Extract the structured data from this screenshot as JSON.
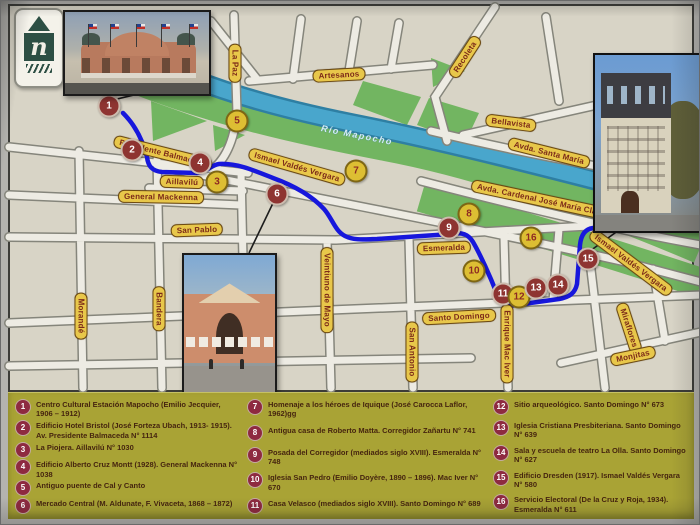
{
  "logo": {
    "letter": "n"
  },
  "map": {
    "colors": {
      "route": "#1717dc",
      "river": "#49a6cc",
      "park": "#72b561",
      "label_bg": "#e8c74a",
      "marker_red": "#8e3431",
      "marker_yellow": "#ddbe33",
      "legend_bg": "#a9a335"
    },
    "river_label": {
      "text": "Río Mapocho",
      "x": 356,
      "y": 134,
      "r": 11
    },
    "street_labels": [
      {
        "text": "Presidente Balmaceda",
        "x": 162,
        "y": 152,
        "r": 14
      },
      {
        "text": "General Mackenna",
        "x": 160,
        "y": 196,
        "r": 1
      },
      {
        "text": "Aillavilú",
        "x": 181,
        "y": 181,
        "r": 2
      },
      {
        "text": "San Pablo",
        "x": 196,
        "y": 229,
        "r": -2
      },
      {
        "text": "Morandé",
        "x": 80,
        "y": 315,
        "r": 90
      },
      {
        "text": "Bandera",
        "x": 158,
        "y": 308,
        "r": 90
      },
      {
        "text": "Veintiuno de Mayo",
        "x": 326,
        "y": 289,
        "r": 90
      },
      {
        "text": "San Antonio",
        "x": 411,
        "y": 351,
        "r": 90
      },
      {
        "text": "Santo Domingo",
        "x": 458,
        "y": 316,
        "r": -3
      },
      {
        "text": "Enrique Mac Iver",
        "x": 506,
        "y": 343,
        "r": 90
      },
      {
        "text": "Esmeralda",
        "x": 443,
        "y": 247,
        "r": -2
      },
      {
        "text": "Miraflores",
        "x": 628,
        "y": 327,
        "r": 72
      },
      {
        "text": "Monjitas",
        "x": 632,
        "y": 355,
        "r": -12
      },
      {
        "text": "La Paz",
        "x": 234,
        "y": 62,
        "r": 90
      },
      {
        "text": "Artesanos",
        "x": 338,
        "y": 74,
        "r": -3
      },
      {
        "text": "Recoleta",
        "x": 464,
        "y": 56,
        "r": -57
      },
      {
        "text": "Bellavista",
        "x": 510,
        "y": 122,
        "r": 7
      },
      {
        "text": "Avda. Santa María",
        "x": 548,
        "y": 152,
        "r": 14
      },
      {
        "text": "Avda. Cardenal José María Claro",
        "x": 540,
        "y": 199,
        "r": 12
      },
      {
        "text": "Ismael Valdés Vergara",
        "x": 296,
        "y": 166,
        "r": 16
      },
      {
        "text": "Ismael Valdés Vergara",
        "x": 630,
        "y": 262,
        "r": 37
      }
    ],
    "markers": [
      {
        "n": "1",
        "x": 108,
        "y": 105,
        "c": "red"
      },
      {
        "n": "2",
        "x": 131,
        "y": 149,
        "c": "red"
      },
      {
        "n": "3",
        "x": 216,
        "y": 181,
        "c": "yellow"
      },
      {
        "n": "4",
        "x": 199,
        "y": 162,
        "c": "red"
      },
      {
        "n": "5",
        "x": 236,
        "y": 120,
        "c": "yellow"
      },
      {
        "n": "6",
        "x": 276,
        "y": 193,
        "c": "red"
      },
      {
        "n": "7",
        "x": 355,
        "y": 170,
        "c": "yellow"
      },
      {
        "n": "8",
        "x": 468,
        "y": 213,
        "c": "yellow"
      },
      {
        "n": "9",
        "x": 448,
        "y": 227,
        "c": "red"
      },
      {
        "n": "10",
        "x": 473,
        "y": 270,
        "c": "yellow"
      },
      {
        "n": "11",
        "x": 502,
        "y": 293,
        "c": "red"
      },
      {
        "n": "12",
        "x": 518,
        "y": 296,
        "c": "yellow"
      },
      {
        "n": "13",
        "x": 535,
        "y": 287,
        "c": "red"
      },
      {
        "n": "14",
        "x": 557,
        "y": 284,
        "c": "red"
      },
      {
        "n": "15",
        "x": 587,
        "y": 258,
        "c": "red"
      },
      {
        "n": "16",
        "x": 530,
        "y": 237,
        "c": "yellow"
      }
    ]
  },
  "legend": {
    "columns": [
      {
        "items": [
          {
            "n": "1",
            "text": "Centro Cultural Estación Mapocho (Emilio Jecquier, 1906 – 1912)"
          },
          {
            "n": "2",
            "text": "Edificio Hotel Bristol (José Forteza Ubach, 1913- 1915). Av. Presidente Balmaceda N° 1114"
          },
          {
            "n": "3",
            "text": "La Piojera. Aillavilú N° 1030"
          },
          {
            "n": "4",
            "text": "Edificio Alberto Cruz Montt (1928). General Mackenna N° 1038"
          },
          {
            "n": "5",
            "text": "Antiguo puente de Cal y Canto"
          },
          {
            "n": "6",
            "text": "Mercado Central (M. Aldunate, F. Vivaceta, 1868 – 1872)"
          }
        ]
      },
      {
        "items": [
          {
            "n": "7",
            "text": "Homenaje a los héroes de Iquique (José Carocca Laflor, 1962)gg"
          },
          {
            "n": "8",
            "text": "Antigua casa de Roberto Matta. Corregidor Zañartu N° 741"
          },
          {
            "n": "9",
            "text": "Posada del Corregidor (mediados siglo XVIII). Esmeralda N° 748"
          },
          {
            "n": "10",
            "text": "Iglesia San Pedro (Emilio Doyère, 1890 – 1896). Mac Iver N° 670"
          },
          {
            "n": "11",
            "text": "Casa Velasco (mediados siglo XVIII). Santo Domingo N° 689"
          }
        ]
      },
      {
        "items": [
          {
            "n": "12",
            "text": "Sitio arqueológico. Santo Domingo N° 673"
          },
          {
            "n": "13",
            "text": "Iglesia Cristiana Presbiteriana. Santo Domingo N° 639"
          },
          {
            "n": "14",
            "text": "Sala y escuela de teatro La Olla. Santo Domingo N° 627"
          },
          {
            "n": "15",
            "text": "Edificio Dresden (1917). Ismael Valdés Vergara N° 580"
          },
          {
            "n": "16",
            "text": "Servicio Electoral (De la Cruz y Roja, 1934). Esmeralda N° 611"
          }
        ]
      }
    ]
  }
}
